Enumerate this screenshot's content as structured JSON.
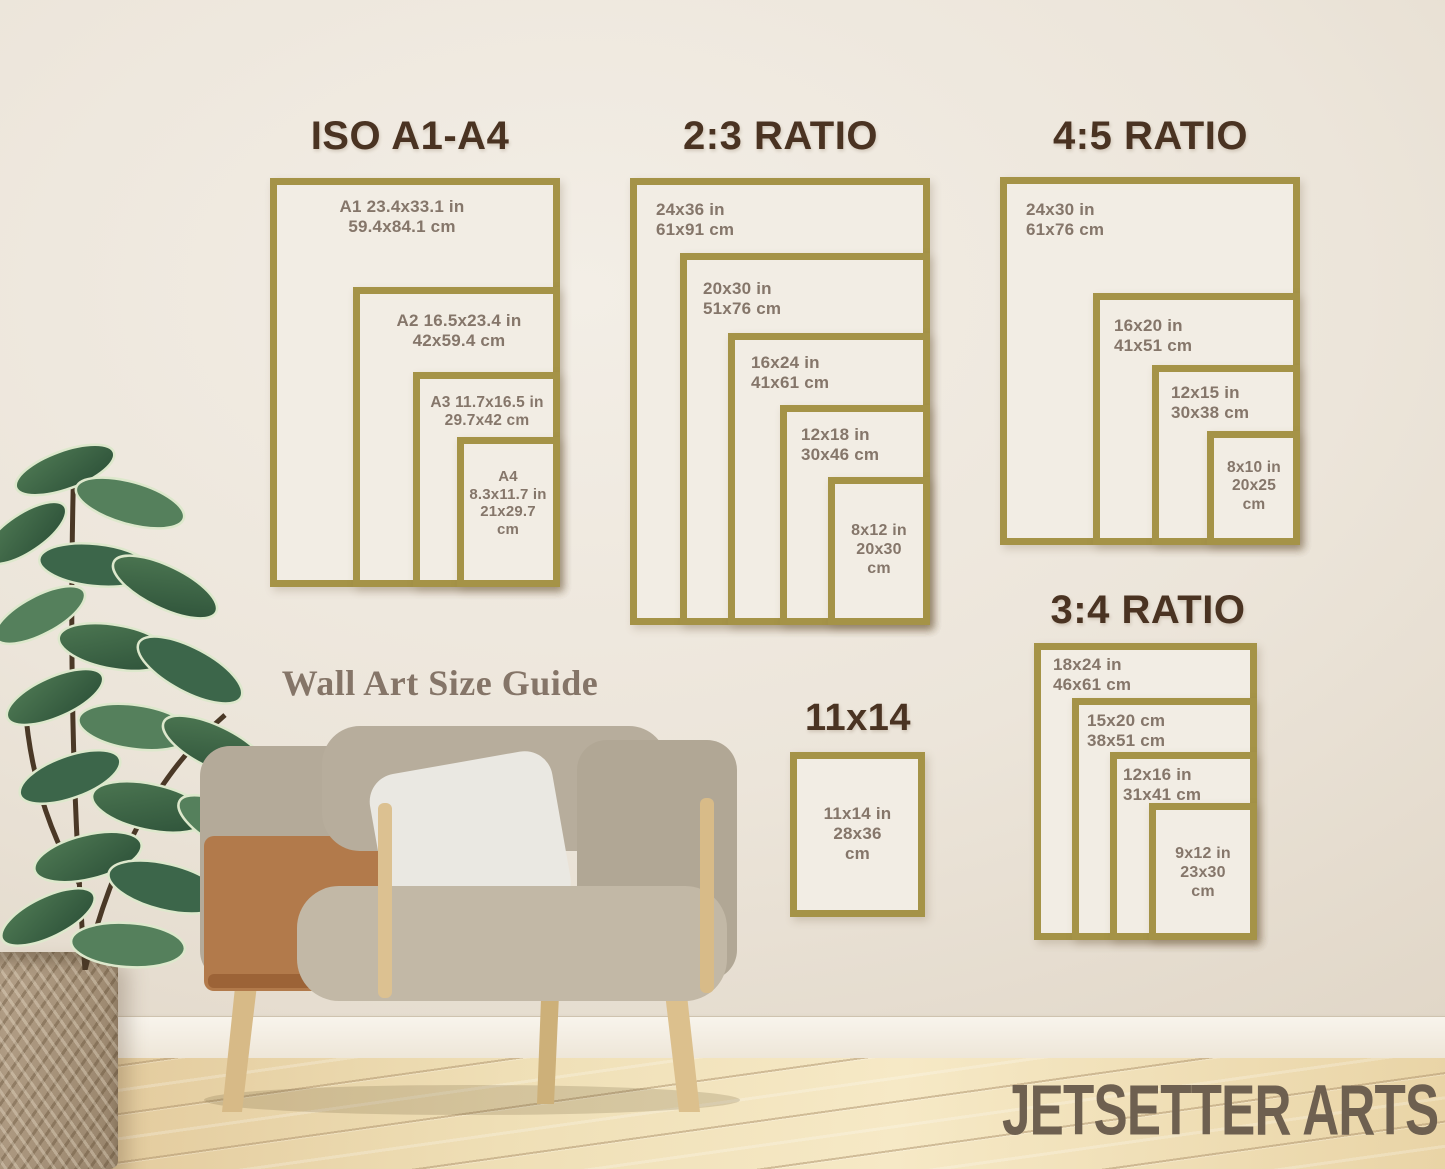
{
  "colors": {
    "frame_gold": "#a59347",
    "title_brown": "#4a3322",
    "label_taupe": "#85766a",
    "caption_taupe": "#857568",
    "brand_brown": "#6e6050",
    "wall_cream": "#ece5da",
    "floor_wood": "#efdfb6"
  },
  "caption": "Wall Art Size Guide",
  "brand": "JETSETTER ARTS",
  "sections": {
    "iso": {
      "title": "ISO A1-A4",
      "frames": [
        {
          "name": "A1",
          "label": "A1 23.4x33.1 in\n59.4x84.1 cm"
        },
        {
          "name": "A2",
          "label": "A2 16.5x23.4 in\n42x59.4 cm"
        },
        {
          "name": "A3",
          "label": "A3 11.7x16.5 in\n29.7x42 cm"
        },
        {
          "name": "A4",
          "label": "A4\n8.3x11.7 in\n21x29.7\ncm"
        }
      ]
    },
    "ratio23": {
      "title": "2:3 RATIO",
      "frames": [
        {
          "name": "24x36",
          "label": "24x36 in\n61x91 cm"
        },
        {
          "name": "20x30",
          "label": "20x30 in\n51x76 cm"
        },
        {
          "name": "16x24",
          "label": "16x24 in\n41x61 cm"
        },
        {
          "name": "12x18",
          "label": "12x18 in\n30x46 cm"
        },
        {
          "name": "8x12",
          "label": "8x12 in\n20x30\ncm"
        }
      ]
    },
    "ratio45": {
      "title": "4:5 RATIO",
      "frames": [
        {
          "name": "24x30",
          "label": "24x30 in\n61x76 cm"
        },
        {
          "name": "16x20",
          "label": "16x20 in\n41x51 cm"
        },
        {
          "name": "12x15",
          "label": "12x15 in\n30x38 cm"
        },
        {
          "name": "8x10",
          "label": "8x10 in\n20x25\ncm"
        }
      ]
    },
    "ratio34": {
      "title": "3:4 RATIO",
      "frames": [
        {
          "name": "18x24",
          "label": "18x24 in\n46x61 cm"
        },
        {
          "name": "15x20",
          "label": "15x20 cm\n38x51 cm"
        },
        {
          "name": "12x16",
          "label": "12x16 in\n31x41 cm"
        },
        {
          "name": "9x12",
          "label": "9x12 in\n23x30\ncm"
        }
      ]
    },
    "size1114": {
      "title": "11x14",
      "frames": [
        {
          "name": "11x14",
          "label": "11x14 in\n28x36\ncm"
        }
      ]
    }
  }
}
